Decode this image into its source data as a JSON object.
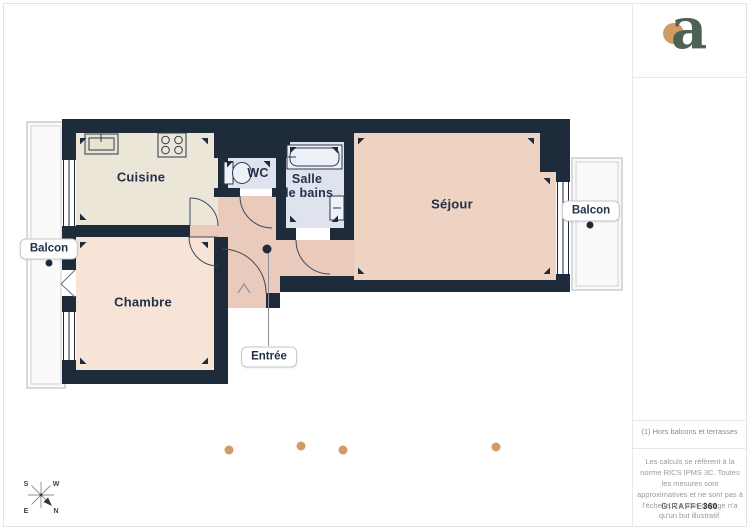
{
  "floor_plan": {
    "rooms": {
      "cuisine": {
        "label": "Cuisine"
      },
      "wc": {
        "label": "WC"
      },
      "salle_de_bains": {
        "label_line1": "Salle",
        "label_line2": "de bains"
      },
      "sejour": {
        "label": "Séjour"
      },
      "chambre": {
        "label": "Chambre"
      }
    },
    "tags": {
      "balcon_left": "Balcon",
      "balcon_right": "Balcon",
      "entree": "Entrée"
    },
    "fixture_icons": [
      "kitchen-sink-icon",
      "stove-hob-icon",
      "toilet-icon",
      "bathtub-icon",
      "bathroom-sink-icon"
    ],
    "colors": {
      "wall": "#1e2b3a",
      "cuisine": "#ebe6d7",
      "chambre": "#f7e4d6",
      "sejour": "#eed2c2",
      "hall": "#e9cabb",
      "bathroom": "#dfe3ee",
      "balcony_fill": "#fbfafa",
      "camera_dot": "#cf9d63",
      "logo_green": "#4e6254",
      "logo_dot": "#cf9d63"
    }
  },
  "compass": {
    "south": "S",
    "west": "W",
    "east": "E",
    "north": "N"
  },
  "sidebar": {
    "logo_letter": "a",
    "footnote": "(1) Hors balcons et terrasses",
    "disclaimer": "Les calculs se réfèrent à la norme RICS IPMS 3C. Toutes les mesures sont approximatives et ne sont pas à l'échelle. Ce plan d'étage n'a qu'un but illustratif.",
    "brand_name": "GIRAFFE",
    "brand_suffix": "360"
  }
}
